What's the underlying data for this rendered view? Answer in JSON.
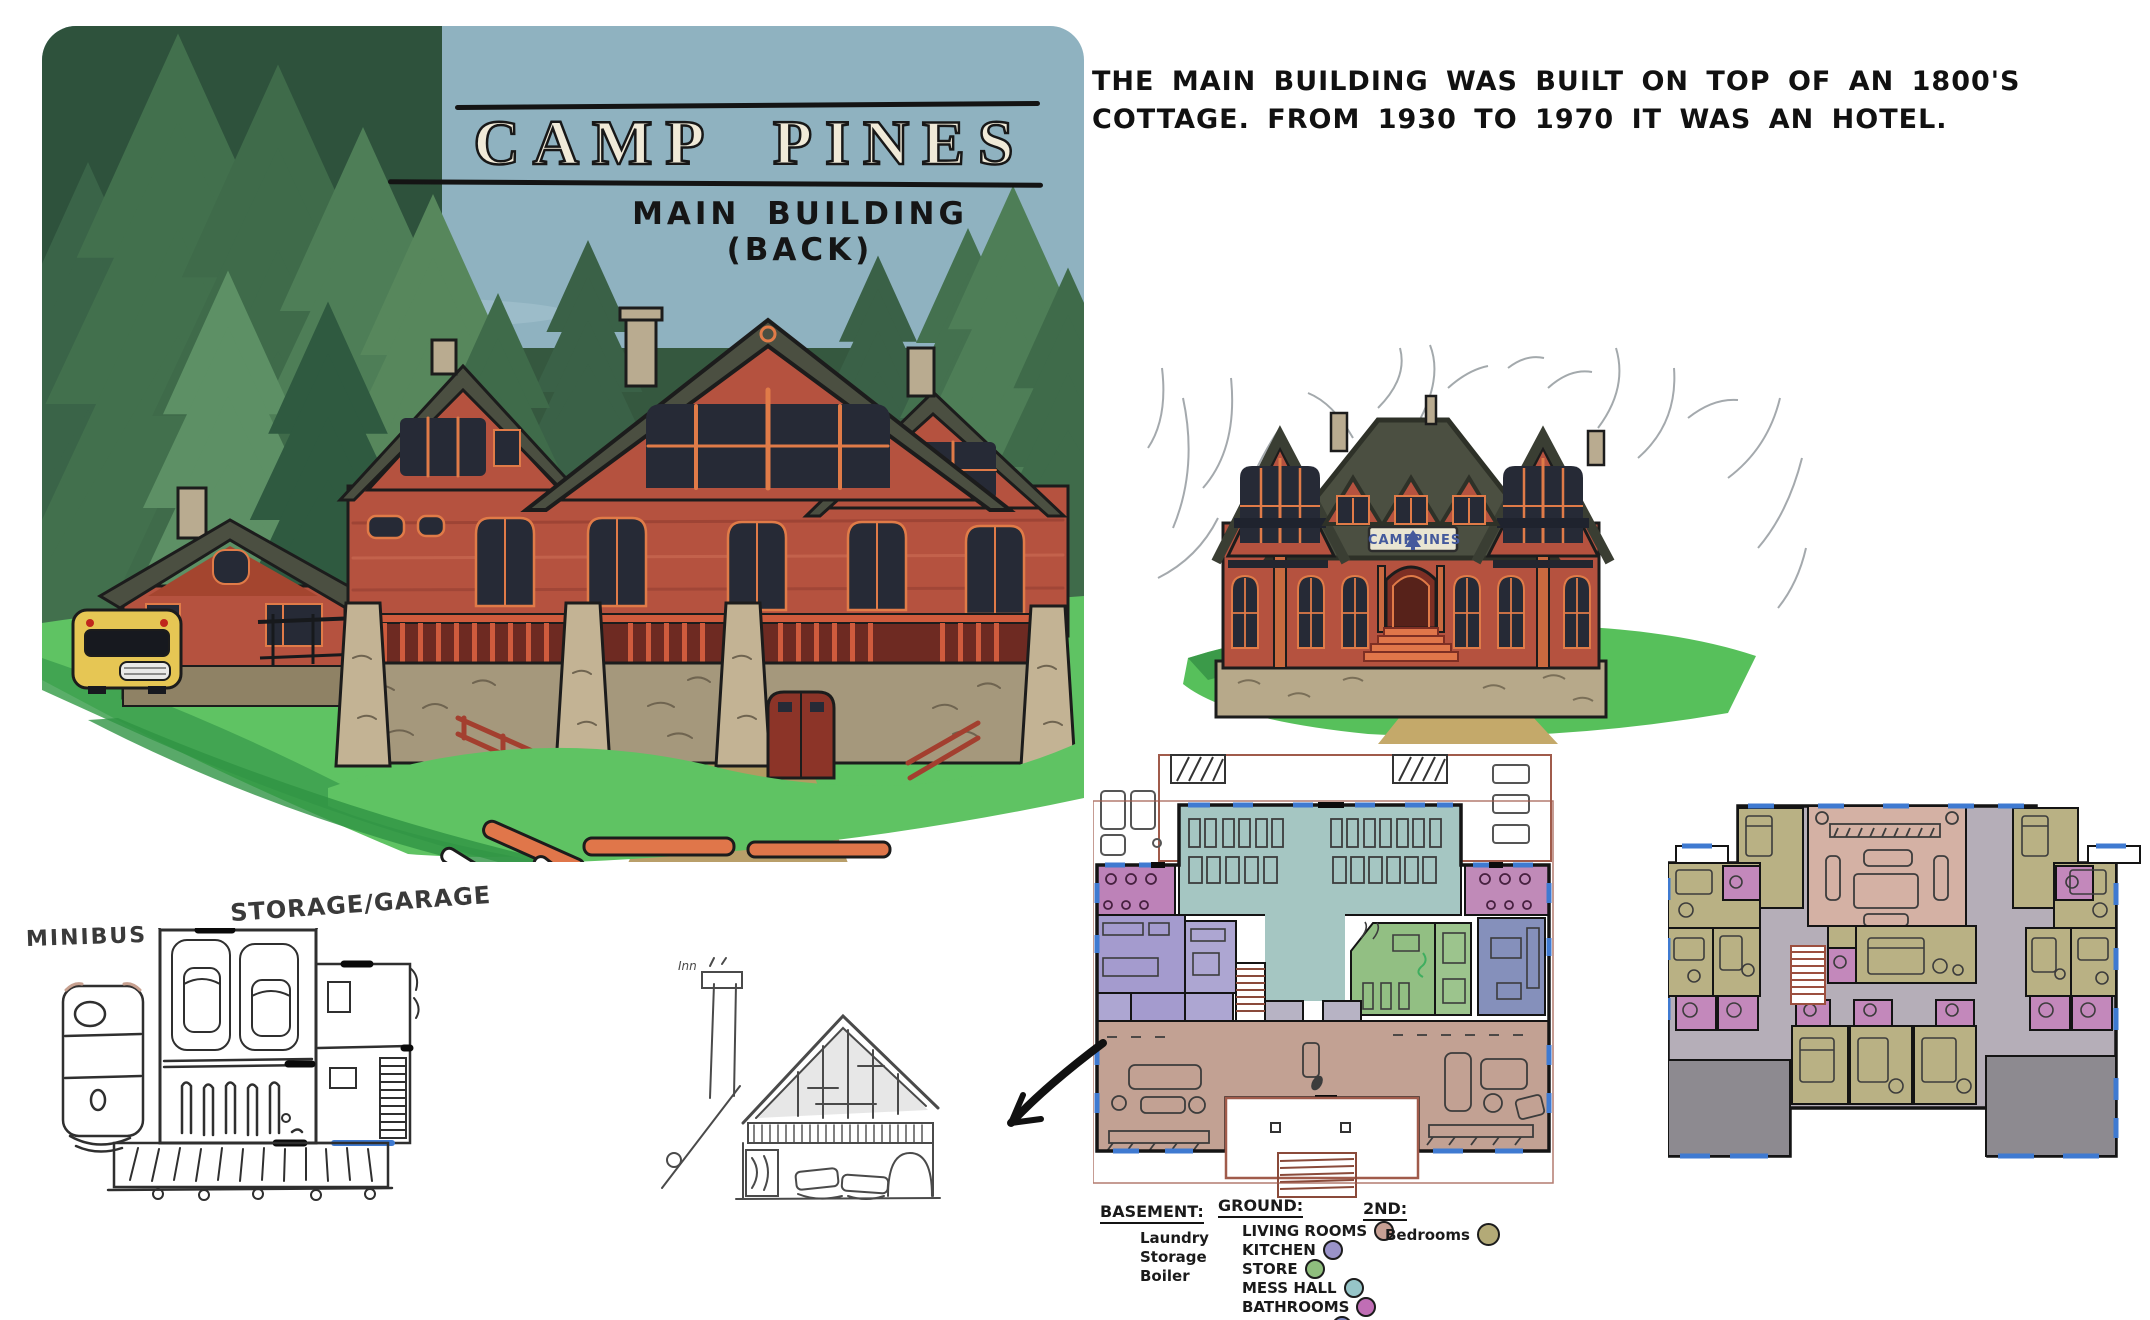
{
  "back_view": {
    "title": "CAMP PINES",
    "subtitle": "MAIN BUILDING (BACK)"
  },
  "note": {
    "line1": "THE MAIN BUILDING WAS BUILT ON TOP OF AN 1800'S",
    "line2": "COTTAGE. FROM 1930 TO 1970 IT WAS AN HOTEL."
  },
  "front_view": {
    "sign_left": "CAMP",
    "sign_right": "PINES",
    "sign_icon": "pine-tree-icon"
  },
  "outbuildings": {
    "minibus_label": "MINIBUS",
    "storage_garage_label": "STORAGE/GARAGE",
    "inn_label": "Inn"
  },
  "legend": {
    "basement": {
      "title": "BASEMENT:",
      "items": [
        {
          "label": "Laundry"
        },
        {
          "label": "Storage"
        },
        {
          "label": "Boiler"
        }
      ]
    },
    "ground": {
      "title": "GROUND:",
      "items": [
        {
          "label": "LIVING ROOMS",
          "color": "#c7a094"
        },
        {
          "label": "KITCHEN",
          "color": "#9a93c9"
        },
        {
          "label": "STORE",
          "color": "#8fbe7d"
        },
        {
          "label": "MESS HALL",
          "color": "#96c5c8"
        },
        {
          "label": "BATHROOMS",
          "color": "#c06eb5"
        },
        {
          "label": "LIBRARY",
          "color": "#7b85bf"
        }
      ]
    },
    "second": {
      "title": "2ND:",
      "items": [
        {
          "label": "Bedrooms",
          "color": "#b3aa77"
        }
      ]
    }
  },
  "palette": {
    "sky": "#8fb2c0",
    "grass": "#5fc363",
    "path_dirt": "#b59a62",
    "wall_red": "#b5523f",
    "roof_dark": "#4b4f41",
    "window_dark": "#262a36",
    "window_frame_orange": "#e07b48",
    "stone": "#bcac8b",
    "bus_yellow": "#e6c654",
    "plan_window_blue": "#3f7ad1",
    "plan_outline_red": "#a05b4b",
    "hall_gray": "#b5aeb8",
    "roof_gray": "#8d8a90",
    "stairs_red": "#9c4f3f"
  }
}
